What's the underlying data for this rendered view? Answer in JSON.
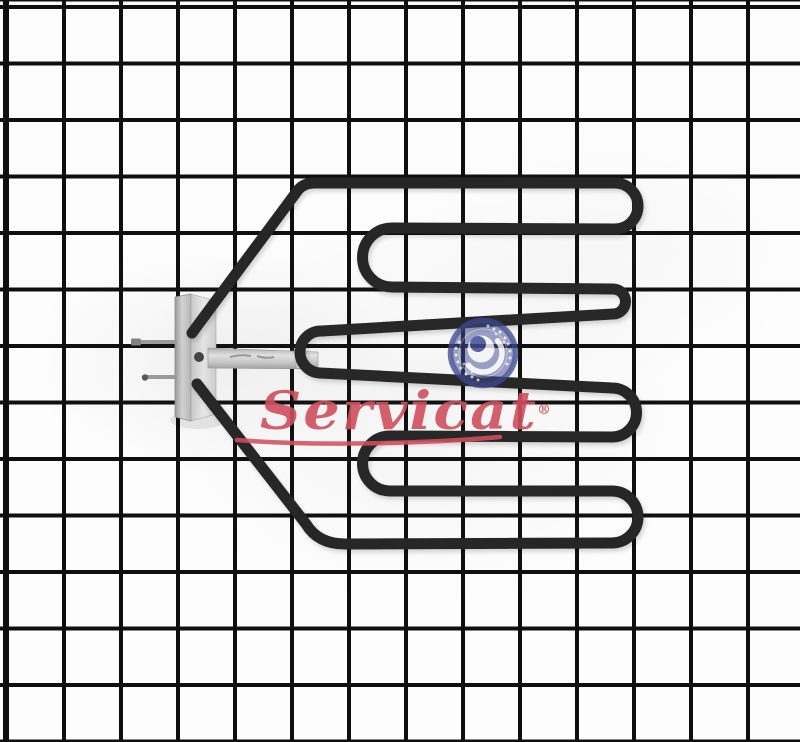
{
  "scene": {
    "type": "product-photo",
    "subject": "Oven broil heating element displayed on a white wire-grid panel"
  },
  "watermark": {
    "brand_text": "Servicat",
    "registered_mark": "®",
    "text_color": "#d6505e",
    "logo": {
      "name": "servicat-emblem",
      "color": "#3f4b96"
    }
  },
  "palette": {
    "background": "#fdfdfd",
    "grid_line": "#0f0f0f",
    "element_tube": "#282828",
    "bracket_metal": "#d2d2d2",
    "terminal_wire": "#9f9f9f"
  }
}
